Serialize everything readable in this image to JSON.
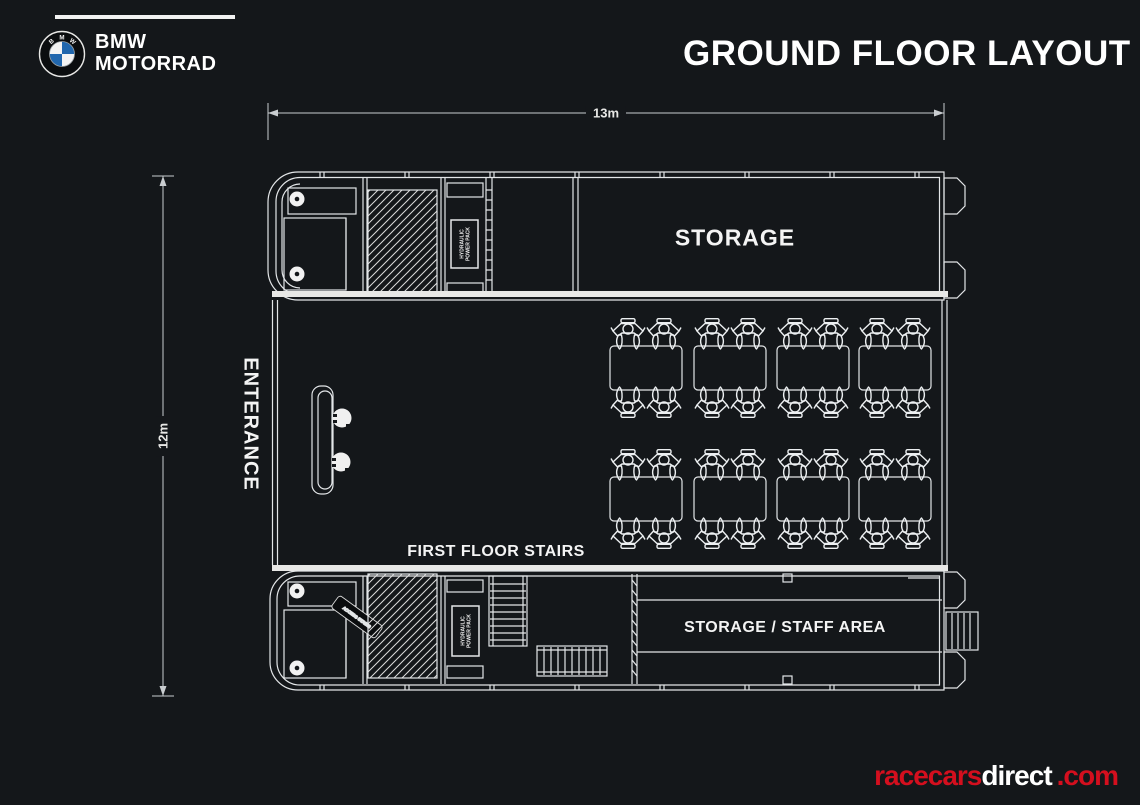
{
  "header": {
    "brand_line1": "BMW",
    "brand_line2": "MOTORRAD",
    "roundel_letters": [
      "B",
      "M",
      "W"
    ],
    "title": "GROUND FLOOR LAYOUT"
  },
  "dimensions": {
    "width": "13m",
    "height": "12m"
  },
  "plan_labels": {
    "entrance": "ENTERANCE",
    "storage": "STORAGE",
    "first_floor_stairs": "FIRST FLOOR STAIRS",
    "storage_staff_area": "STORAGE / STAFF AREA",
    "hydraulic_line1": "HYDRAULIC",
    "hydraulic_line2": "POWER PACK",
    "access_label": "ACCESS STAIRS"
  },
  "bike_stations": {
    "rows": 2,
    "columns": 4,
    "bikes_per_station": 4,
    "total_bikes": 32
  },
  "footer": {
    "brand_red": "racecars",
    "brand_white": "direct",
    "brand_suffix": ".com"
  },
  "colors": {
    "background": "#14171a",
    "line": "#e8e8e6",
    "accent_red": "#d40f1e",
    "bmw_blue": "#2167ae"
  }
}
